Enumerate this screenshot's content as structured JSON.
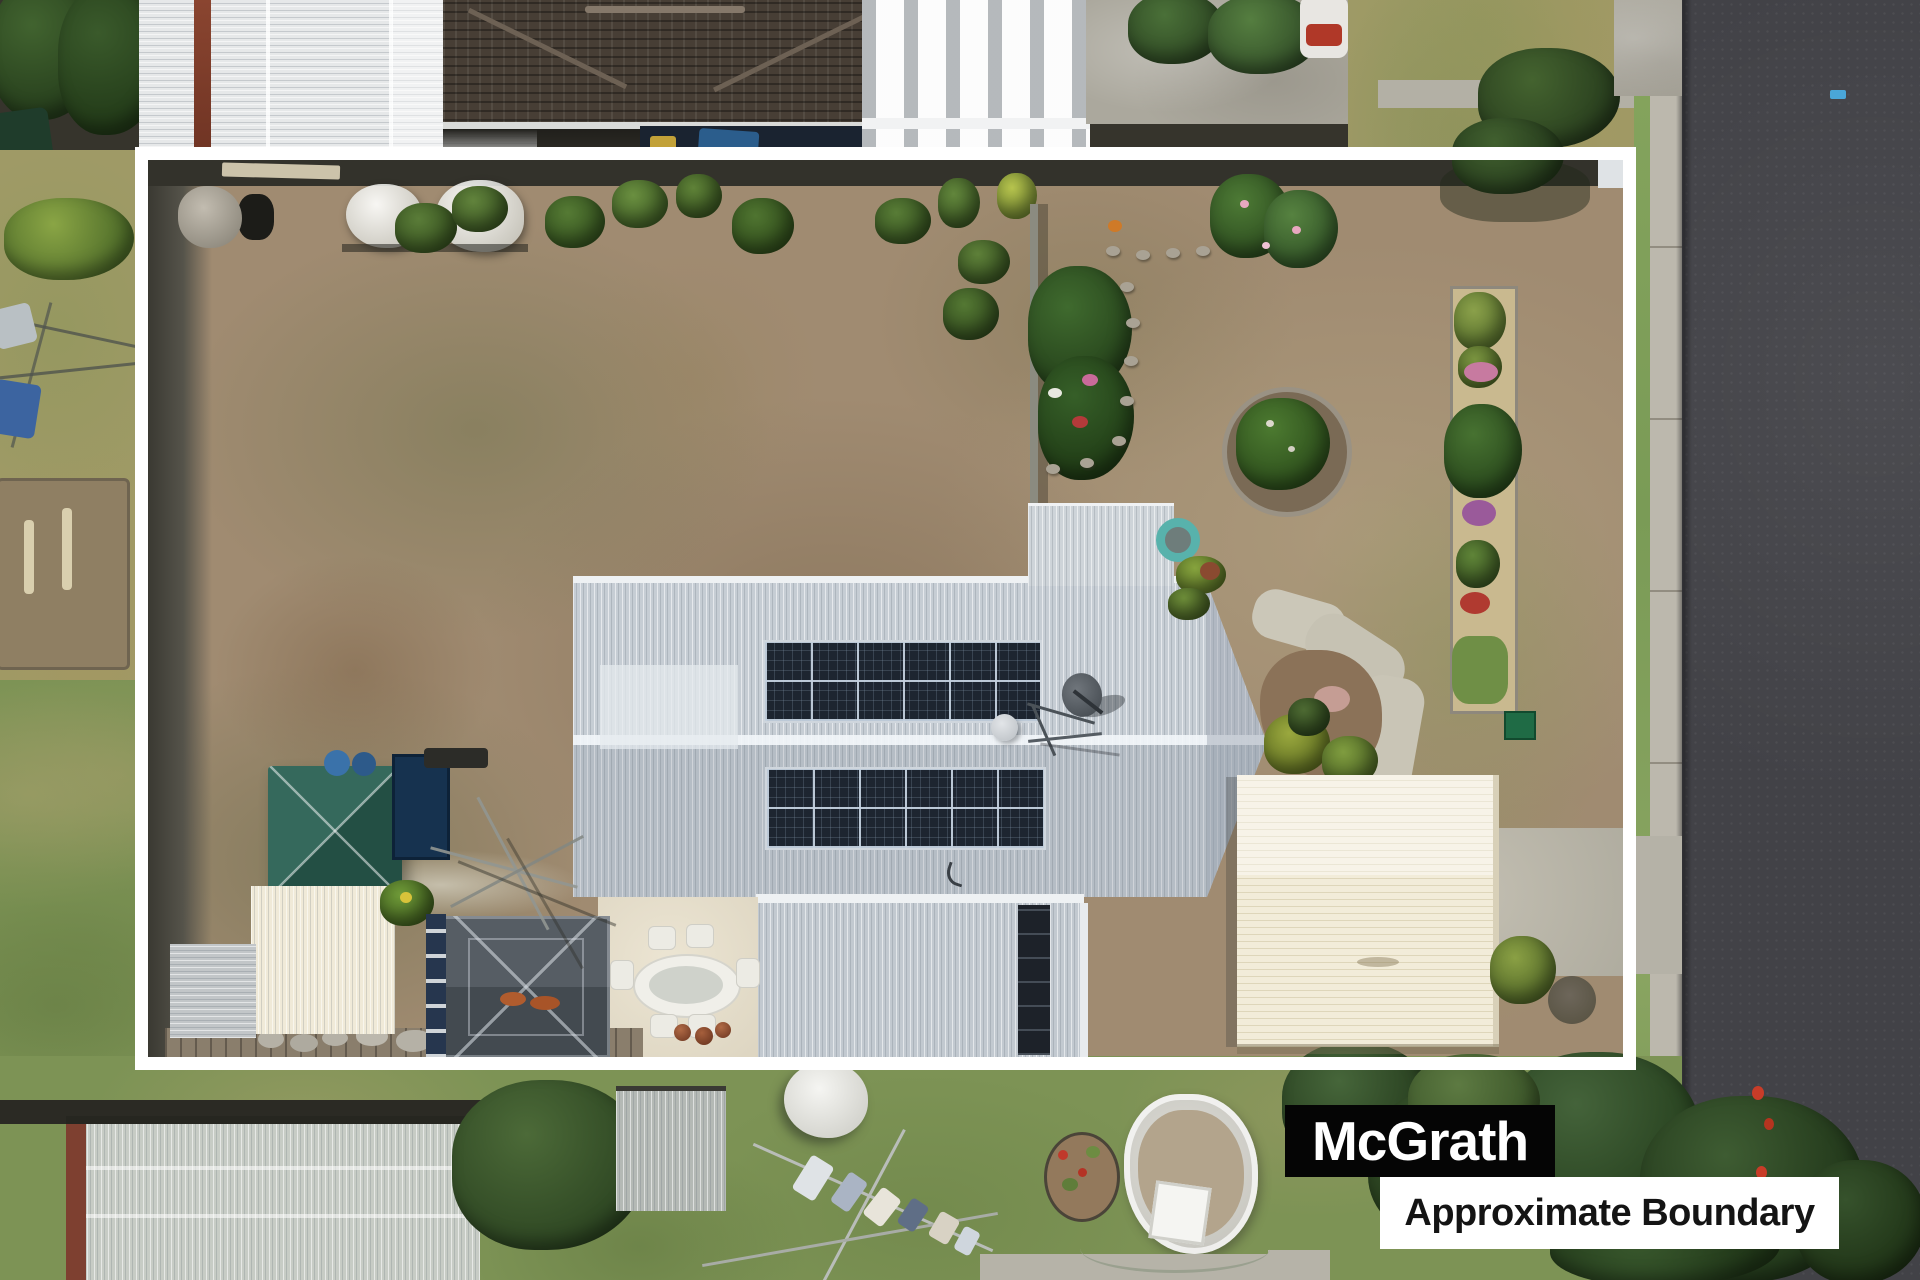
{
  "page": {
    "title": "Aerial drone photo of residential property with boundary overlay"
  },
  "watermark": {
    "brand": "McGrath",
    "caption": "Approximate Boundary",
    "brand_bg": "#050505",
    "brand_fg": "#ffffff",
    "caption_bg": "#ffffff",
    "caption_fg": "#141414"
  },
  "boundary_overlay": {
    "color": "#ffffff",
    "stroke_px": 13,
    "left": 135,
    "top": 147,
    "width": 1501,
    "height": 923
  },
  "scene": {
    "description": "Top-down aerial photo: suburban house with light grey corrugated roof and two rooftop solar arrays, satellite dish, cream garage roof, green pyramid gazebo, dark pergola, outdoor dining set, dry patchy back lawn, garden beds with flowers, internal fence, concrete driveway to road on right, neighbouring roofs top and bottom, street trees over road bottom-right",
    "palette": {
      "road_asphalt": "#424247",
      "kerb_concrete": "#bcb8ad",
      "verge_grass": "#7fa05a",
      "dry_lawn": "#a08b71",
      "green_lawn": "#7d9355",
      "house_roof": "#c6cdd4",
      "garage_roof": "#f2ecd9",
      "solar_panel": "#1d2530",
      "gazebo_green": "#2c6152",
      "tile_roof_brown": "#473e35",
      "tree_green": "#3c5a30",
      "boundary_line": "#ffffff"
    }
  }
}
